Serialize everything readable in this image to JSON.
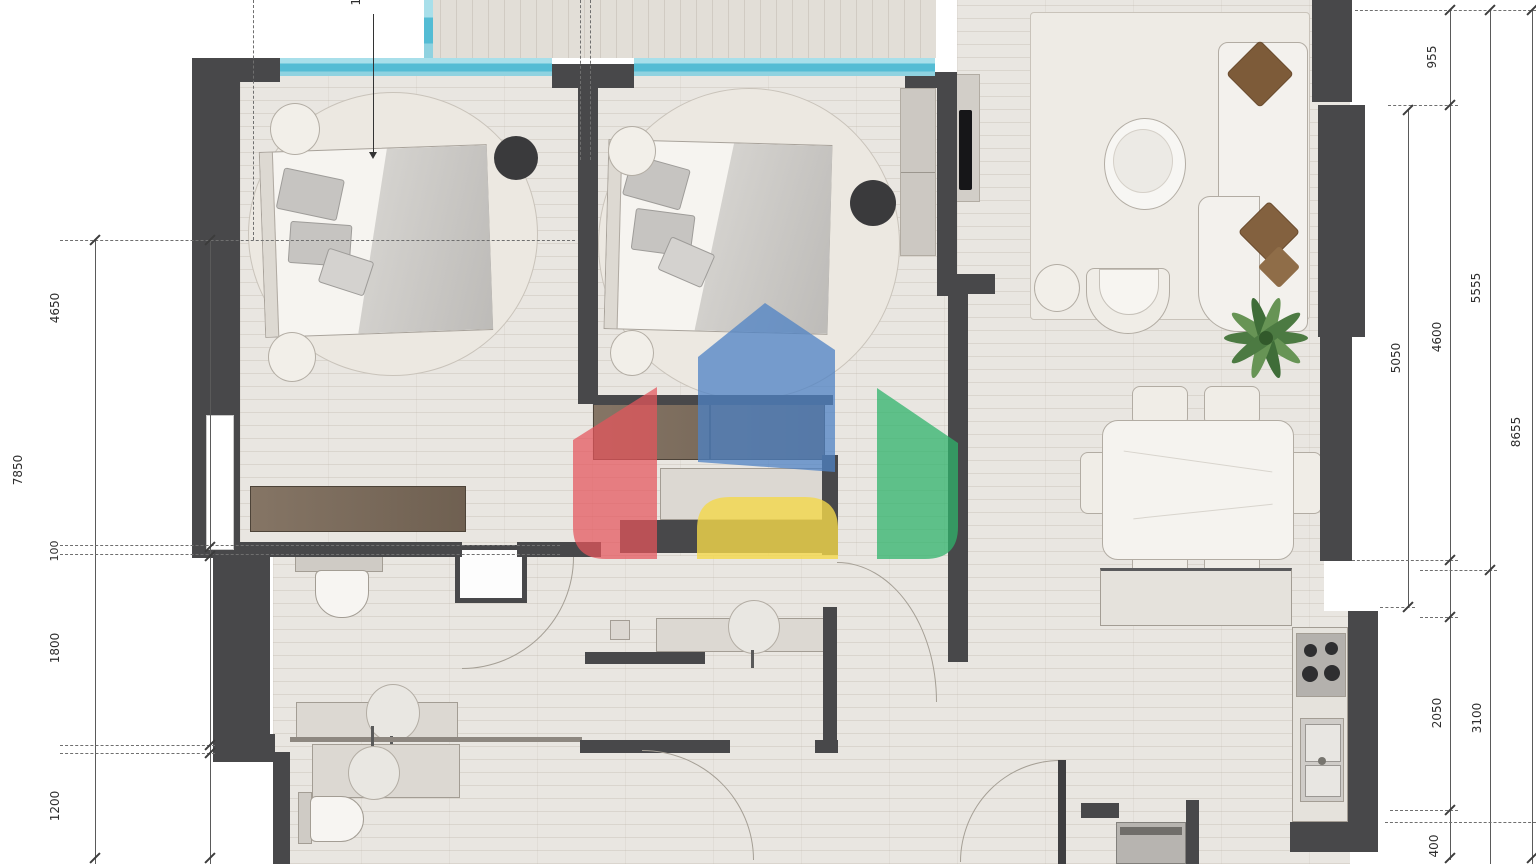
{
  "dimensions": {
    "top_partial": "15",
    "left": [
      {
        "label": "7850"
      },
      {
        "label": "4650"
      },
      {
        "label": "100"
      },
      {
        "label": "1800"
      },
      {
        "label": "1200"
      }
    ],
    "right": [
      {
        "label": "955"
      },
      {
        "label": "5050"
      },
      {
        "label": "4600"
      },
      {
        "label": "5555"
      },
      {
        "label": "8655"
      },
      {
        "label": "2050"
      },
      {
        "label": "3100"
      },
      {
        "label": "400"
      }
    ]
  },
  "watermark": {
    "icon": "house-logo-watermark",
    "blue": "#4e82c4",
    "red": "#e4555b",
    "green": "#2fb36b",
    "yellow": "#f4d84a"
  },
  "colors": {
    "wall": "#48484a",
    "window_glass": "#54bcd4",
    "floor": "#e9e6e1",
    "balcony_floor": "#e2ded7"
  }
}
